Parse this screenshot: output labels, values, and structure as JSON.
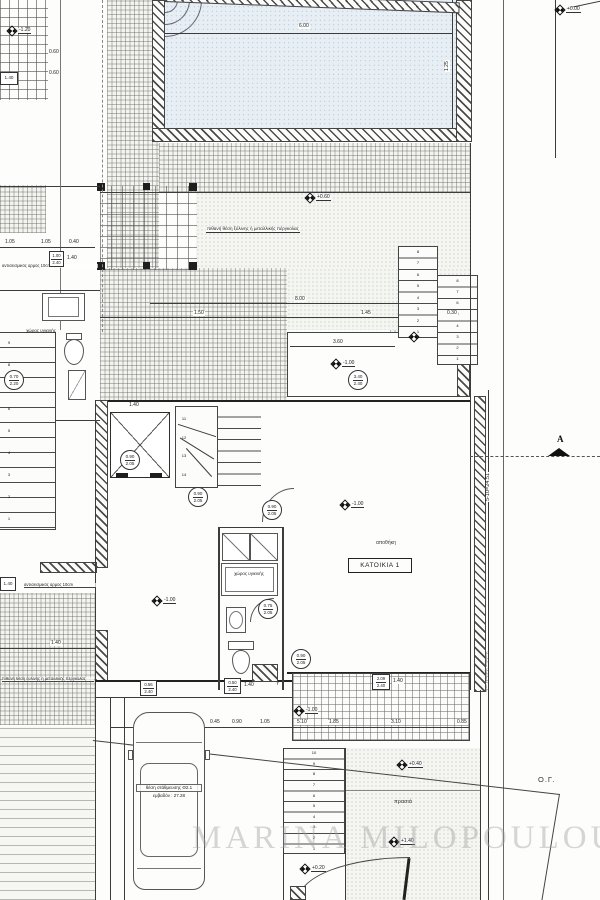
{
  "watermark": "MARINA MILOPOULOU",
  "labels": {
    "pergola_note": "πιθανή θέση ξύλινης ή μεταλλικής πέργκολας",
    "pergola_note2": "πιθανή θέση ξύλινης ή μεταλλικής πέργκολας",
    "seismic_joint_top": "αντισεισμικός αρμός 10cm",
    "seismic_joint_bottom": "αντισεισμικός αρμός 10cm",
    "sanitary_left": "χώρος υγιεινής",
    "sanitary_center": "χώρος υγιεινής",
    "storage": "αποθήκη",
    "residence": "ΚΑΤΟΙΚΙΑ 1",
    "parking_title": "θέση στάθμευσης Θ2.1",
    "parking_area": "εμβαδόν : 27.28",
    "garden": "πρασιά",
    "building_line": "Ο.Γ.",
    "section_letter": "A",
    "total_dimension": "5-10=24.51",
    "boundary_note": "όριο γραμμής δόμησης",
    "axis_y": "Y"
  },
  "levels": {
    "top_right": "+0.00",
    "terrace": "+0.60",
    "trellis": "-1.20",
    "room_right": "-1.00",
    "hall": "-1.00",
    "room_left": "-1.00",
    "grate": "-1.00",
    "garden_upper": "+0.40",
    "garden_lower": "+1.40",
    "entry": "+0.20"
  },
  "door_tags": {
    "elevator": [
      "0.90",
      "2.05"
    ],
    "stair_hall": [
      "0.90",
      "2.05"
    ],
    "hall_room": [
      "0.90",
      "2.05"
    ],
    "bath_center": [
      "0.75",
      "2.05"
    ],
    "bath_left": [
      "0.70",
      "2.20"
    ],
    "room_right": [
      "3.40",
      "2.40"
    ]
  },
  "box_tags": {
    "top_left": "1.40",
    "mid_left": [
      "1.00",
      "2.40"
    ],
    "mid_left_w": "1.40",
    "seismic": "1.40",
    "bath": [
      "0.50",
      "2.40"
    ],
    "bath_w": "1.40",
    "annex": [
      "0.56",
      "2.40"
    ],
    "grate": [
      "2.09",
      "2.40"
    ],
    "grate_w": "1.40"
  },
  "dims": {
    "pool_width": "6.00",
    "pool_side": "1.25",
    "terrace_width": "8.00",
    "t1": "1.50",
    "t2": "1.45",
    "room_width": "3.60",
    "wall_top": "1.40",
    "left1": "0.60",
    "left2": "0.60",
    "left3": "1.05",
    "left4": "1.05",
    "left5": "0.40",
    "left6": "1.40",
    "stair_tread": "0.30",
    "park": [
      "2.50",
      "0.45",
      "0.90",
      "1.05"
    ],
    "grate_row": [
      "5.10",
      "1.85",
      "3.10",
      "0.85"
    ]
  },
  "stairs": {
    "upper_flight": [
      "8",
      "7",
      "6",
      "5",
      "4",
      "3",
      "2",
      "1"
    ],
    "lower_flight": [
      "8",
      "7",
      "6",
      "5",
      "4",
      "3",
      "2",
      "1"
    ],
    "winder": [
      "11",
      "12",
      "13",
      "14"
    ],
    "outdoor": [
      "10",
      "9",
      "8",
      "7",
      "6",
      "5",
      "4",
      "3",
      "2",
      "1"
    ],
    "left_flight": [
      "9",
      "8",
      "7",
      "6",
      "5",
      "4",
      "3",
      "2",
      "1"
    ]
  }
}
